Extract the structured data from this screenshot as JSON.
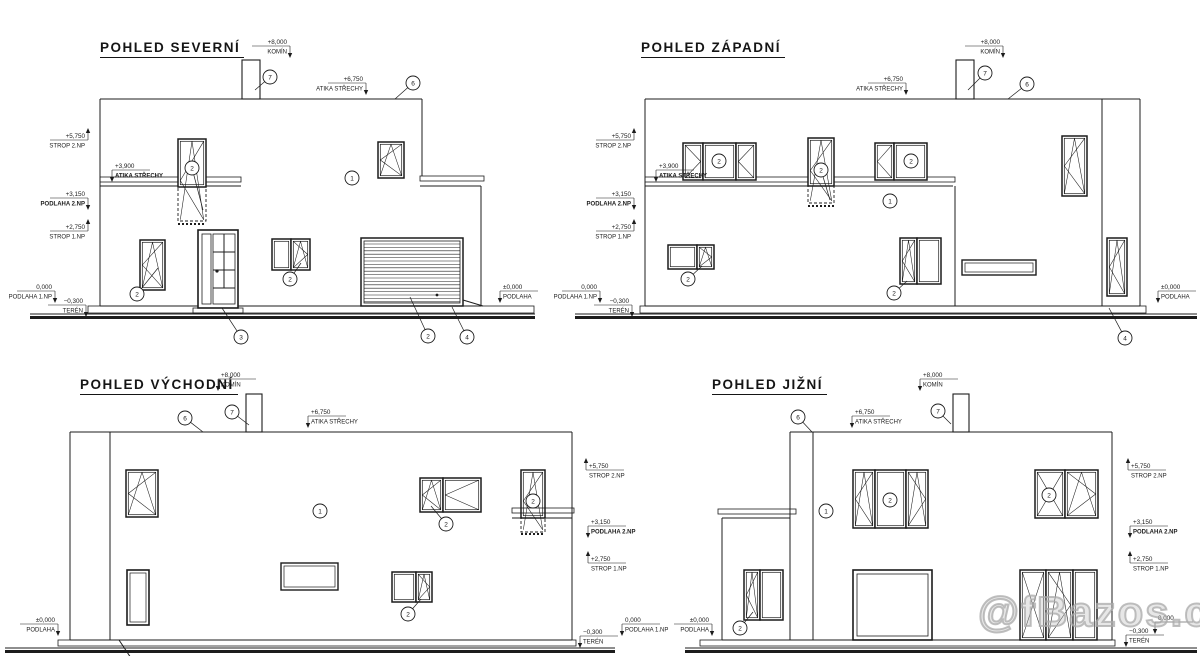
{
  "meta": {
    "ink": "#1c1c1c",
    "background": "#ffffff"
  },
  "watermark": {
    "text": "@fBazos.cz"
  },
  "views": [
    {
      "id": "north",
      "title": "POHLED SEVERNÍ",
      "shapes": [
        [
          "ln",
          100,
          99,
          422,
          99
        ],
        [
          "ln",
          100,
          99,
          100,
          306
        ],
        [
          "ln",
          422,
          99,
          422,
          176
        ],
        [
          "rc",
          242,
          60,
          18,
          39,
          1.1
        ],
        [
          "rc",
          100,
          177,
          141,
          5,
          0.8
        ],
        [
          "ln",
          100,
          186,
          241,
          186
        ],
        [
          "rc",
          420,
          176,
          64,
          5,
          0.8
        ],
        [
          "ln",
          420,
          186,
          481,
          186
        ],
        [
          "ln",
          481,
          186,
          481,
          306
        ],
        [
          "ln",
          100,
          306,
          481,
          306
        ],
        [
          "rc",
          88,
          306,
          446,
          7,
          0.8
        ],
        [
          "ln",
          30,
          314,
          535,
          314
        ],
        [
          "fr",
          30,
          316,
          505,
          3
        ],
        [
          "win",
          140,
          240,
          25,
          50,
          "lt"
        ],
        [
          "win",
          178,
          139,
          28,
          48,
          ""
        ],
        [
          "dr",
          178,
          187,
          28,
          34
        ],
        [
          "dl",
          178,
          224,
          206,
          224
        ],
        [
          "sym",
          178,
          139,
          28,
          83,
          "lt"
        ],
        [
          "rc",
          198,
          230,
          40,
          78,
          1.6,
          1
        ],
        [
          "rc",
          202,
          234,
          9,
          70,
          0.8
        ],
        [
          "rc",
          213,
          234,
          22,
          70,
          0.8
        ],
        [
          "ln",
          224,
          234,
          224,
          288
        ],
        [
          "ln",
          213,
          252,
          235,
          252
        ],
        [
          "ln",
          213,
          270,
          235,
          270
        ],
        [
          "ln",
          213,
          288,
          235,
          288
        ],
        [
          "dot",
          217,
          271,
          1.6
        ],
        [
          "rc",
          193,
          308,
          50,
          5,
          0.8
        ],
        [
          "win",
          272,
          239,
          19,
          31,
          ""
        ],
        [
          "win",
          291,
          239,
          19,
          31,
          "rt"
        ],
        [
          "win",
          378,
          142,
          26,
          36,
          "lt"
        ],
        [
          "gar",
          361,
          238,
          102,
          68
        ],
        [
          "dot",
          437,
          295,
          1.4
        ],
        [
          "ln",
          463,
          300,
          483,
          306
        ]
      ],
      "callouts": [
        [
          "7",
          270,
          77,
          255,
          90
        ],
        [
          "6",
          413,
          83,
          395,
          99
        ],
        [
          "2",
          192,
          168,
          203,
          210
        ],
        [
          "2",
          137,
          294,
          158,
          268
        ],
        [
          "3",
          241,
          337,
          222,
          308
        ],
        [
          "2",
          290,
          279,
          301,
          263
        ],
        [
          "1",
          352,
          178
        ],
        [
          "2",
          428,
          336,
          410,
          297
        ],
        [
          "4",
          467,
          337,
          452,
          307
        ]
      ],
      "marks": [
        {
          "v": "+8,000",
          "t": "KOMÍN",
          "x": 290,
          "y": 44,
          "d": "d"
        },
        {
          "v": "+6,750",
          "t": "ATIKA STŘECHY",
          "x": 366,
          "y": 81,
          "d": "d"
        },
        {
          "v": "+5,750",
          "t": "STROP 2.NP",
          "x": 88,
          "y": 138,
          "d": "u"
        },
        {
          "v": "+3,900",
          "t": "ATIKA STŘECHY",
          "x": 112,
          "y": 168,
          "d": "d",
          "as": "l",
          "b": 1
        },
        {
          "v": "+3,150",
          "t": "PODLAHA 2.NP",
          "x": 88,
          "y": 196,
          "d": "d",
          "b": 1
        },
        {
          "v": "+2,750",
          "t": "STROP 1.NP",
          "x": 88,
          "y": 229,
          "d": "u"
        },
        {
          "v": "0,000",
          "t": "PODLAHA 1.NP",
          "x": 55,
          "y": 289,
          "d": "d"
        },
        {
          "v": "−0,300",
          "t": "TERÉN",
          "x": 86,
          "y": 303,
          "d": "d"
        },
        {
          "v": "±0,000",
          "t": "PODLAHA",
          "x": 500,
          "y": 289,
          "d": "d",
          "as": "l"
        }
      ]
    },
    {
      "id": "west",
      "title": "POHLED ZÁPADNÍ",
      "shapes": [
        [
          "ln",
          645,
          99,
          1140,
          99
        ],
        [
          "ln",
          645,
          99,
          645,
          306
        ],
        [
          "ln",
          1140,
          99,
          1140,
          306
        ],
        [
          "ln",
          645,
          306,
          1140,
          306
        ],
        [
          "ln",
          1102,
          99,
          1102,
          306
        ],
        [
          "rc",
          956,
          60,
          18,
          39,
          1.1
        ],
        [
          "rc",
          645,
          177,
          310,
          5,
          0.8
        ],
        [
          "ln",
          645,
          186,
          953,
          186
        ],
        [
          "ln",
          955,
          186,
          955,
          306
        ],
        [
          "rc",
          640,
          306,
          506,
          7,
          0.8
        ],
        [
          "ln",
          575,
          314,
          1197,
          314
        ],
        [
          "fr",
          575,
          316,
          622,
          3
        ],
        [
          "win",
          683,
          143,
          20,
          37,
          "r"
        ],
        [
          "win",
          703,
          143,
          33,
          37,
          ""
        ],
        [
          "win",
          736,
          143,
          20,
          37,
          "l"
        ],
        [
          "win",
          808,
          138,
          26,
          48,
          ""
        ],
        [
          "dr",
          808,
          186,
          26,
          17
        ],
        [
          "dl",
          808,
          206,
          834,
          206
        ],
        [
          "sym",
          808,
          138,
          26,
          65,
          "lt"
        ],
        [
          "win",
          875,
          143,
          19,
          37,
          "l"
        ],
        [
          "win",
          894,
          143,
          33,
          37,
          ""
        ],
        [
          "win",
          668,
          245,
          29,
          24,
          ""
        ],
        [
          "win",
          697,
          245,
          17,
          24,
          "rt"
        ],
        [
          "win",
          900,
          238,
          17,
          46,
          "lt"
        ],
        [
          "win",
          917,
          238,
          24,
          46,
          ""
        ],
        [
          "rc",
          962,
          260,
          74,
          15,
          1.4
        ],
        [
          "rc",
          965,
          263,
          68,
          9,
          0.7
        ],
        [
          "win",
          1062,
          136,
          25,
          60,
          "lt"
        ],
        [
          "win",
          1107,
          238,
          20,
          58,
          "lt"
        ]
      ],
      "callouts": [
        [
          "7",
          985,
          73,
          968,
          90
        ],
        [
          "6",
          1027,
          84,
          1008,
          99
        ],
        [
          "2",
          719,
          161
        ],
        [
          "2",
          821,
          170,
          830,
          200
        ],
        [
          "2",
          911,
          161
        ],
        [
          "1",
          890,
          201
        ],
        [
          "2",
          688,
          279,
          702,
          266
        ],
        [
          "2",
          894,
          293,
          907,
          281
        ],
        [
          "4",
          1125,
          338,
          1109,
          308
        ]
      ],
      "marks": [
        {
          "v": "+8,000",
          "t": "KOMÍN",
          "x": 1003,
          "y": 44,
          "d": "d"
        },
        {
          "v": "+6,750",
          "t": "ATIKA STŘECHY",
          "x": 906,
          "y": 81,
          "d": "d"
        },
        {
          "v": "+5,750",
          "t": "STROP 2.NP",
          "x": 634,
          "y": 138,
          "d": "u"
        },
        {
          "v": "+3,900",
          "t": "ATIKA STŘECHY",
          "x": 656,
          "y": 168,
          "d": "d",
          "as": "l",
          "b": 1
        },
        {
          "v": "+3,150",
          "t": "PODLAHA 2.NP",
          "x": 634,
          "y": 196,
          "d": "d",
          "b": 1
        },
        {
          "v": "+2,750",
          "t": "STROP 1.NP",
          "x": 634,
          "y": 229,
          "d": "u"
        },
        {
          "v": "0,000",
          "t": "PODLAHA 1.NP",
          "x": 600,
          "y": 289,
          "d": "d"
        },
        {
          "v": "−0,300",
          "t": "TERÉN",
          "x": 632,
          "y": 303,
          "d": "d"
        },
        {
          "v": "±0,000",
          "t": "PODLAHA",
          "x": 1158,
          "y": 289,
          "d": "d",
          "as": "l"
        }
      ]
    },
    {
      "id": "east",
      "title": "POHLED VÝCHODNÍ",
      "shapes": [
        [
          "ln",
          70,
          432,
          572,
          432
        ],
        [
          "ln",
          70,
          432,
          70,
          640
        ],
        [
          "ln",
          572,
          432,
          572,
          640
        ],
        [
          "ln",
          70,
          640,
          572,
          640
        ],
        [
          "ln",
          110,
          432,
          110,
          640
        ],
        [
          "rc",
          246,
          394,
          16,
          38,
          1.1
        ],
        [
          "win",
          521,
          470,
          24,
          48,
          ""
        ],
        [
          "rc",
          512,
          508,
          62,
          5,
          0.8
        ],
        [
          "ln",
          512,
          518,
          572,
          518
        ],
        [
          "dr",
          521,
          518,
          24,
          14
        ],
        [
          "dl",
          521,
          534,
          545,
          534
        ],
        [
          "sym",
          521,
          470,
          24,
          62,
          "lt"
        ],
        [
          "win",
          126,
          470,
          32,
          47,
          "lt"
        ],
        [
          "rc",
          127,
          570,
          22,
          55,
          1.6,
          1
        ],
        [
          "rc",
          130,
          573,
          16,
          49,
          0.7
        ],
        [
          "win",
          420,
          478,
          23,
          34,
          "lt"
        ],
        [
          "win",
          443,
          478,
          38,
          34,
          "l"
        ],
        [
          "win",
          392,
          572,
          24,
          30,
          ""
        ],
        [
          "win",
          416,
          572,
          16,
          30,
          "rt"
        ],
        [
          "rc",
          281,
          563,
          57,
          27,
          1.4
        ],
        [
          "rc",
          284,
          566,
          51,
          21,
          0.7
        ],
        [
          "rc",
          58,
          640,
          518,
          6,
          0.8
        ],
        [
          "ln",
          5,
          648,
          615,
          648
        ],
        [
          "fr",
          5,
          650,
          610,
          3
        ],
        [
          "ln",
          119,
          640,
          131,
          658
        ]
      ],
      "callouts": [
        [
          "7",
          232,
          412,
          249,
          425
        ],
        [
          "6",
          185,
          418,
          203,
          432
        ],
        [
          "1",
          320,
          511
        ],
        [
          "2",
          446,
          524,
          431,
          506
        ],
        [
          "2",
          533,
          501
        ],
        [
          "2",
          408,
          614,
          421,
          599
        ]
      ],
      "marks": [
        {
          "v": "+8,000",
          "t": "KOMÍN",
          "x": 218,
          "y": 377,
          "d": "d",
          "as": "l"
        },
        {
          "v": "+6,750",
          "t": "ATIKA STŘECHY",
          "x": 308,
          "y": 414,
          "d": "d",
          "as": "l"
        },
        {
          "v": "+5,750",
          "t": "STROP 2.NP",
          "x": 586,
          "y": 468,
          "d": "u",
          "as": "l"
        },
        {
          "v": "+3,150",
          "t": "PODLAHA 2.NP",
          "x": 588,
          "y": 524,
          "d": "d",
          "as": "l",
          "b": 1
        },
        {
          "v": "+2,750",
          "t": "STROP 1.NP",
          "x": 588,
          "y": 561,
          "d": "u",
          "as": "l"
        },
        {
          "v": "0,000",
          "t": "PODLAHA 1.NP",
          "x": 622,
          "y": 622,
          "d": "d",
          "as": "l"
        },
        {
          "v": "−0,300",
          "t": "TERÉN",
          "x": 580,
          "y": 634,
          "d": "d",
          "as": "l"
        },
        {
          "v": "±0,000",
          "t": "PODLAHA",
          "x": 58,
          "y": 622,
          "d": "d"
        }
      ]
    },
    {
      "id": "south",
      "title": "POHLED JIŽNÍ",
      "shapes": [
        [
          "ln",
          790,
          432,
          1112,
          432
        ],
        [
          "ln",
          790,
          432,
          790,
          640
        ],
        [
          "ln",
          1112,
          432,
          1112,
          640
        ],
        [
          "ln",
          813,
          432,
          813,
          640
        ],
        [
          "rc",
          953,
          394,
          16,
          38,
          1.1
        ],
        [
          "ln",
          722,
          518,
          722,
          640
        ],
        [
          "rc",
          718,
          509,
          78,
          5,
          0.8
        ],
        [
          "ln",
          722,
          518,
          790,
          518
        ],
        [
          "ln",
          722,
          640,
          1112,
          640
        ],
        [
          "win",
          744,
          570,
          16,
          50,
          "lt"
        ],
        [
          "win",
          760,
          570,
          23,
          50,
          ""
        ],
        [
          "win",
          853,
          470,
          22,
          58,
          "lt"
        ],
        [
          "win",
          875,
          470,
          31,
          58,
          ""
        ],
        [
          "win",
          906,
          470,
          22,
          58,
          "rt"
        ],
        [
          "rc",
          853,
          570,
          79,
          70,
          1.6,
          1
        ],
        [
          "rc",
          857,
          574,
          71,
          62,
          0.8
        ],
        [
          "win",
          1035,
          470,
          30,
          48,
          "x"
        ],
        [
          "win",
          1065,
          470,
          33,
          48,
          "rt"
        ],
        [
          "win",
          1020,
          570,
          26,
          70,
          "x"
        ],
        [
          "win",
          1046,
          570,
          27,
          70,
          "rt"
        ],
        [
          "win",
          1073,
          570,
          24,
          70,
          ""
        ],
        [
          "rc",
          700,
          640,
          415,
          6,
          0.8
        ],
        [
          "ln",
          685,
          648,
          1197,
          648
        ],
        [
          "fr",
          685,
          650,
          512,
          3
        ]
      ],
      "callouts": [
        [
          "7",
          938,
          411,
          951,
          424
        ],
        [
          "6",
          798,
          417,
          812,
          432
        ],
        [
          "2",
          890,
          500
        ],
        [
          "1",
          826,
          511
        ],
        [
          "2",
          740,
          628,
          753,
          612
        ],
        [
          "2",
          1049,
          495
        ]
      ],
      "marks": [
        {
          "v": "+8,000",
          "t": "KOMÍN",
          "x": 920,
          "y": 377,
          "d": "d",
          "as": "l"
        },
        {
          "v": "+6,750",
          "t": "ATIKA STŘECHY",
          "x": 852,
          "y": 414,
          "d": "d",
          "as": "l"
        },
        {
          "v": "+5,750",
          "t": "STROP 2.NP",
          "x": 1128,
          "y": 468,
          "d": "u",
          "as": "l"
        },
        {
          "v": "+3,150",
          "t": "PODLAHA 2.NP",
          "x": 1130,
          "y": 524,
          "d": "d",
          "as": "l",
          "b": 1
        },
        {
          "v": "+2,750",
          "t": "STROP 1.NP",
          "x": 1130,
          "y": 561,
          "d": "u",
          "as": "l"
        },
        {
          "v": "0,000",
          "t": "",
          "x": 1155,
          "y": 620,
          "d": "d",
          "as": "l"
        },
        {
          "v": "−0,300",
          "t": "TERÉN",
          "x": 1126,
          "y": 633,
          "d": "d",
          "as": "l"
        },
        {
          "v": "±0,000",
          "t": "PODLAHA",
          "x": 712,
          "y": 622,
          "d": "d"
        }
      ]
    }
  ]
}
